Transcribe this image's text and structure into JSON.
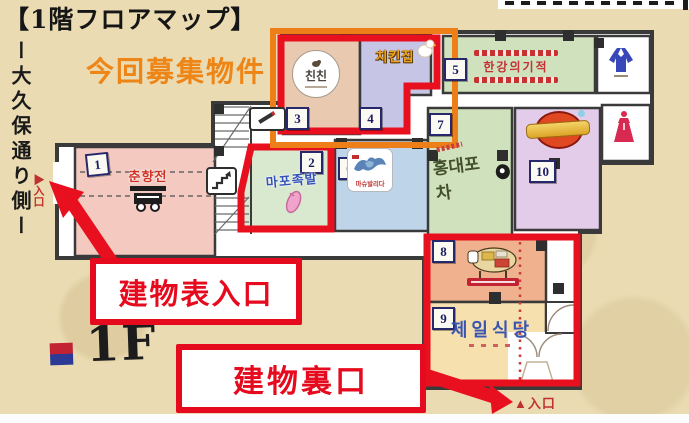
{
  "page": {
    "title": "【1階フロアマップ】",
    "highlight_label": "今回募集物件",
    "floor_badge": "1F",
    "street_side_label": "ー大久保通り側ー"
  },
  "annotations": {
    "front_entrance": "建物表入口",
    "back_entrance": "建物裏口",
    "left_entrance_marker": "▶入口",
    "bottom_entrance_marker": "▲入口"
  },
  "units": [
    {
      "no": "1",
      "name": "춘향전",
      "logo": "food-cart-icon"
    },
    {
      "no": "2",
      "name": "마포족발",
      "logo": "pig-trotter-icon"
    },
    {
      "no": "3",
      "name": "친친",
      "logo": "round-seal-logo"
    },
    {
      "no": "4",
      "name": "치킨집",
      "logo": "white-chicken-icon"
    },
    {
      "no": "5",
      "name": "한강의기적",
      "logo": "red-striped-banner-logo"
    },
    {
      "no": "6",
      "name": "마슈발리다",
      "logo": "blue-eagle-art-logo"
    },
    {
      "no": "7",
      "name": "홍대포차",
      "logo": "brush-calligraphy-logo"
    },
    {
      "no": "8",
      "name": "",
      "logo": "beef-cuts-cow-icon"
    },
    {
      "no": "9",
      "name": "제일식당",
      "logo": ""
    },
    {
      "no": "10",
      "name": "",
      "logo": "gold-red-round-logo"
    }
  ],
  "facilities": {
    "male_restroom": "male-hanbok-icon",
    "female_restroom": "female-hanbok-icon",
    "smoking_area": "cigarette-icon",
    "staircase": "stairs"
  },
  "colors": {
    "paper_bg": "#eadbb2",
    "map_wall": "#3a3a3a",
    "highlight_orange": "#ee7f18",
    "alert_red": "#e60a1e",
    "unit1": "#f3c9c0",
    "unit2": "#d9e9d0",
    "unit3": "#e9c9b0",
    "unit4": "#c7c5e6",
    "unit5": "#cfe2bd",
    "unit6": "#bed4e9",
    "unit7": "#cfe2bd",
    "unit8": "#f0b28e",
    "unit9": "#f5e0ae",
    "unit10": "#e3cce9",
    "legend_square_top": "#c22333",
    "legend_square_bottom": "#2c3a96"
  }
}
